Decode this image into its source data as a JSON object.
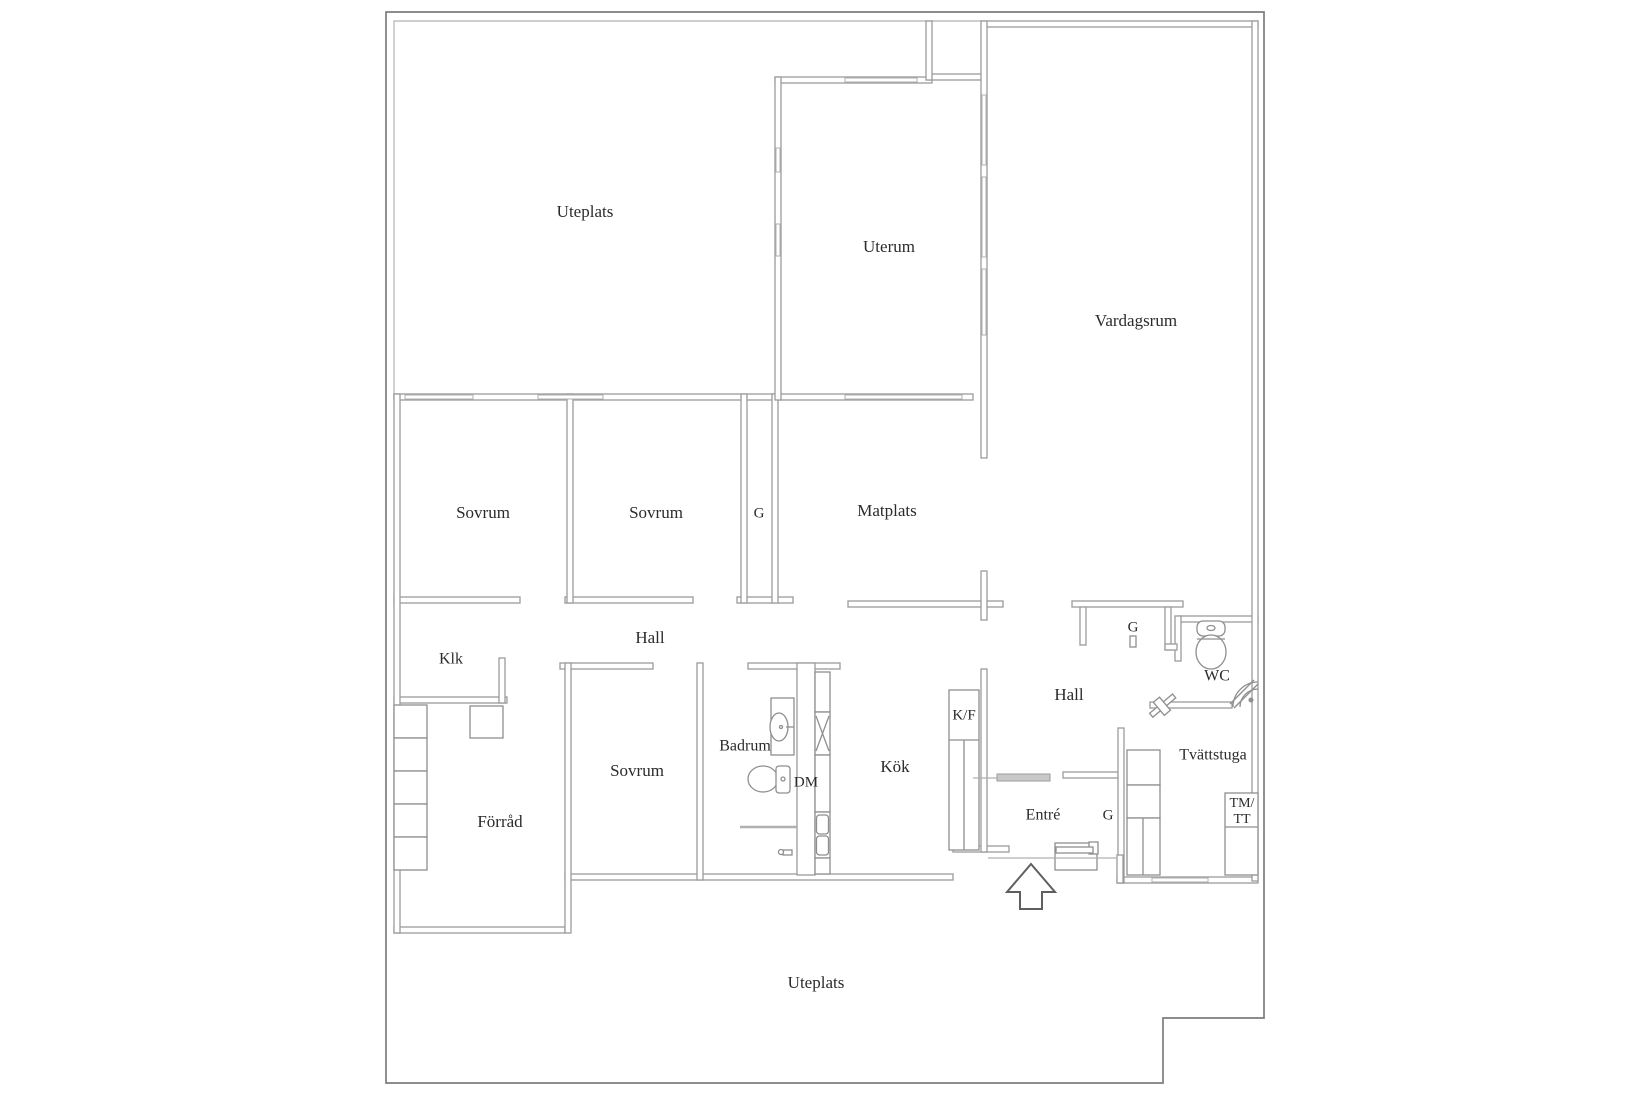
{
  "colors": {
    "wall": "#9b9b9b",
    "boundary": "#7d7d7d",
    "light": "#b0b0b0",
    "fixture": "#8f8f8f",
    "threshold": "#c8c8c8",
    "text": "#2b2b2b"
  },
  "floor_plan": {
    "labels": [
      {
        "id": "uteplats-top",
        "text": "Uteplats",
        "x": 585,
        "y": 213,
        "fs": 17
      },
      {
        "id": "uterum",
        "text": "Uterum",
        "x": 889,
        "y": 248,
        "fs": 17
      },
      {
        "id": "vardagsrum",
        "text": "Vardagsrum",
        "x": 1136,
        "y": 322,
        "fs": 17
      },
      {
        "id": "sovrum-1",
        "text": "Sovrum",
        "x": 483,
        "y": 514,
        "fs": 17
      },
      {
        "id": "sovrum-2",
        "text": "Sovrum",
        "x": 656,
        "y": 514,
        "fs": 17
      },
      {
        "id": "garderob-mid",
        "text": "G",
        "x": 759,
        "y": 514,
        "fs": 15
      },
      {
        "id": "matplats",
        "text": "Matplats",
        "x": 887,
        "y": 512,
        "fs": 17
      },
      {
        "id": "hall-west",
        "text": "Hall",
        "x": 650,
        "y": 639,
        "fs": 17
      },
      {
        "id": "klk",
        "text": "Klk",
        "x": 451,
        "y": 660,
        "fs": 16
      },
      {
        "id": "forrad",
        "text": "Förråd",
        "x": 500,
        "y": 823,
        "fs": 17
      },
      {
        "id": "sovrum-3",
        "text": "Sovrum",
        "x": 637,
        "y": 772,
        "fs": 17
      },
      {
        "id": "badrum",
        "text": "Badrum",
        "x": 745,
        "y": 747,
        "fs": 16
      },
      {
        "id": "dm",
        "text": "DM",
        "x": 806,
        "y": 783,
        "fs": 15
      },
      {
        "id": "kok",
        "text": "Kök",
        "x": 895,
        "y": 768,
        "fs": 17
      },
      {
        "id": "kf",
        "text": "K/F",
        "x": 964,
        "y": 716,
        "fs": 15
      },
      {
        "id": "hall-east",
        "text": "Hall",
        "x": 1069,
        "y": 696,
        "fs": 17
      },
      {
        "id": "entre",
        "text": "Entré",
        "x": 1043,
        "y": 816,
        "fs": 16
      },
      {
        "id": "garderob-entre",
        "text": "G",
        "x": 1108,
        "y": 816,
        "fs": 15
      },
      {
        "id": "garderob-hall",
        "text": "G",
        "x": 1133,
        "y": 628,
        "fs": 15
      },
      {
        "id": "wc",
        "text": "WC",
        "x": 1217,
        "y": 677,
        "fs": 16
      },
      {
        "id": "tvattstuga",
        "text": "Tvättstuga",
        "x": 1213,
        "y": 756,
        "fs": 16
      },
      {
        "id": "tmtt-line1",
        "text": "TM/",
        "x": 1242,
        "y": 804,
        "fs": 14
      },
      {
        "id": "tmtt-line2",
        "text": "TT",
        "x": 1242,
        "y": 820,
        "fs": 14
      },
      {
        "id": "uteplats-bottom",
        "text": "Uteplats",
        "x": 816,
        "y": 984,
        "fs": 17
      }
    ]
  }
}
